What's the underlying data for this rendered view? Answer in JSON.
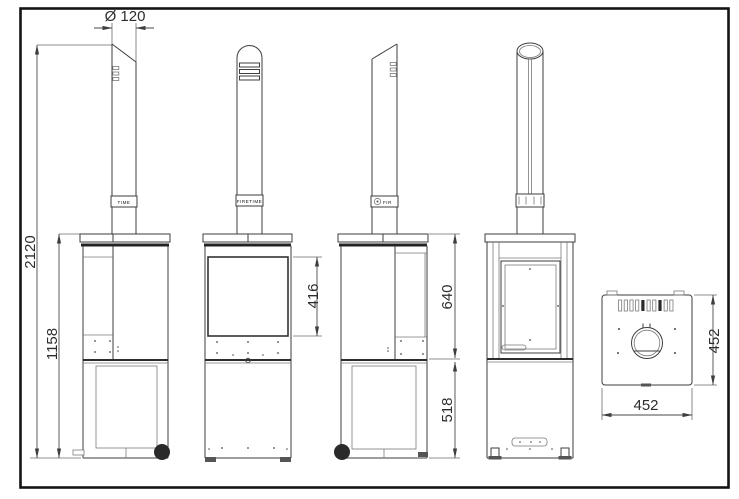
{
  "canvas": {
    "background": "#ffffff",
    "frame_color": "#141414",
    "line_color": "#3e3e3e"
  },
  "dims": {
    "flue_diameter": "Ø 120",
    "total_height": "2120",
    "body_height": "1158",
    "glass_height": "416",
    "stove_section_height": "640",
    "base_height": "518",
    "top_view_depth": "452",
    "top_view_width": "452"
  },
  "branding": {
    "chimney_band_left_view": "TIME",
    "chimney_band_front_view": "FIRETIME",
    "chimney_band_right_view": "FIR"
  }
}
